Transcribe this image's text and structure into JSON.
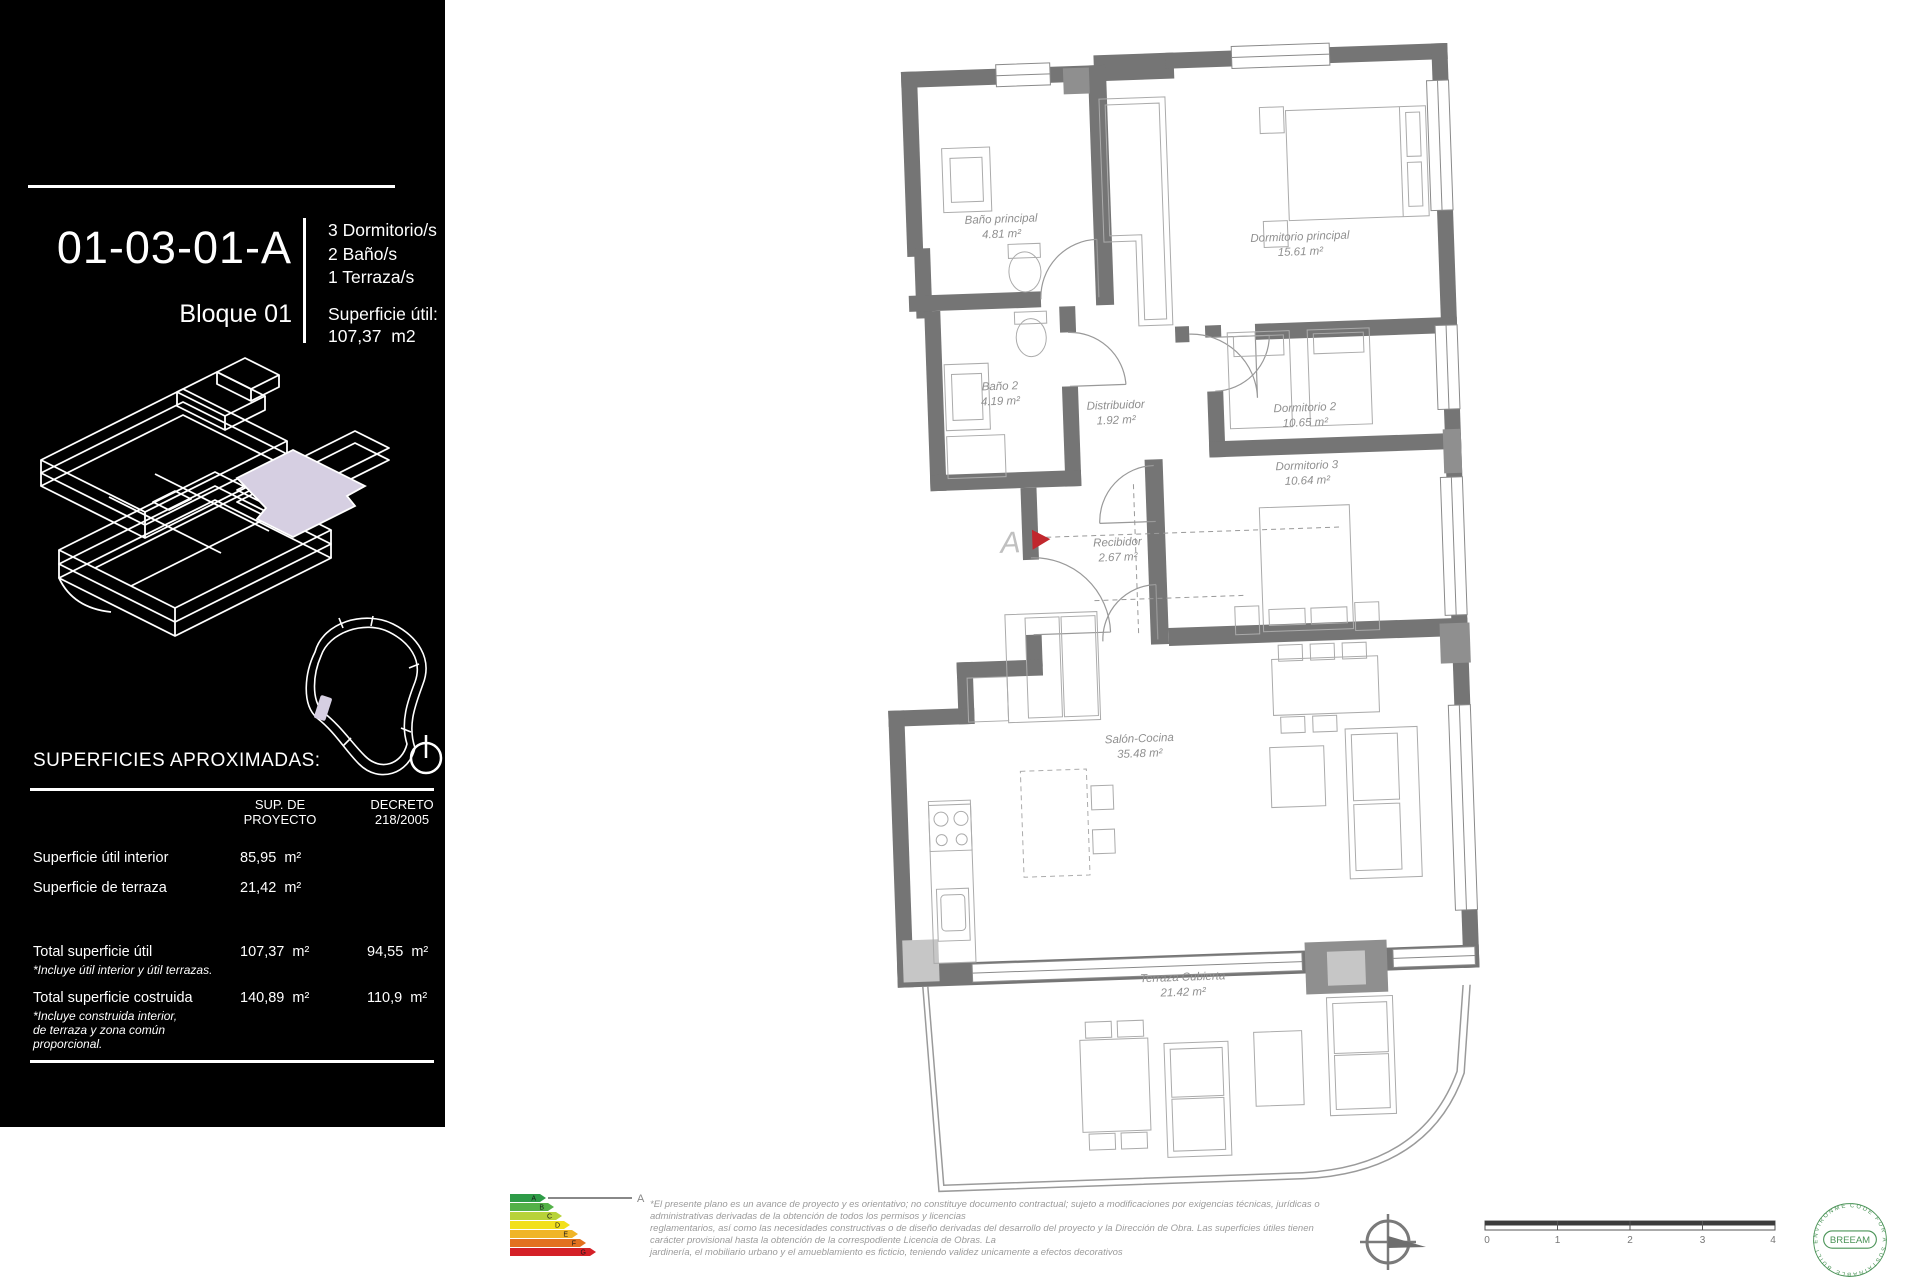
{
  "sidebar": {
    "unit_code": "01-03-01-A",
    "block_label": "Bloque 01",
    "features": {
      "f1": "3 Dormitorio/s",
      "f2": "2 Baño/s",
      "f3": "1 Terraza/s"
    },
    "area_heading": "Superficie útil:",
    "area_value": "107,37  m2",
    "surfaces_heading": "SUPERFICIES APROXIMADAS:",
    "table": {
      "col1_header": "SUP. DE\nPROYECTO",
      "col2_header": "DECRETO\n218/2005",
      "rows": [
        {
          "label": "Superficie útil interior",
          "v1": "85,95  m²",
          "v2": ""
        },
        {
          "label": "Superficie de terraza",
          "v1": "21,42  m²",
          "v2": ""
        },
        {
          "label": "Total superficie útil",
          "note": "*Incluye útil interior y útil terrazas.",
          "v1": "107,37  m²",
          "v2": "94,55  m²"
        },
        {
          "label": "Total superficie costruida",
          "note": "*Incluye construida interior,\nde terraza y zona común\nproporcional.",
          "v1": "140,89  m²",
          "v2": "110,9  m²"
        }
      ]
    },
    "highlight_color": "#d6cfe2"
  },
  "plan": {
    "wall_color": "#757575",
    "rooms": [
      {
        "name": "Baño principal",
        "area": "4.81 m²"
      },
      {
        "name": "Dormitorio principal",
        "area": "15.61 m²"
      },
      {
        "name": "Baño 2",
        "area": "4.19 m²"
      },
      {
        "name": "Distribuidor",
        "area": "1.92 m²"
      },
      {
        "name": "Dormitorio 2",
        "area": "10.65 m²"
      },
      {
        "name": "Dormitorio 3",
        "area": "10.64 m²"
      },
      {
        "name": "Recibidor",
        "area": "2.67 m²"
      },
      {
        "name": "Salón-Cocina",
        "area": "35.48 m²"
      },
      {
        "name": "Terraza Cubierta",
        "area": "21.42 m²"
      }
    ],
    "entrance_label": "A",
    "entrance_marker_color": "#c1272d"
  },
  "footer": {
    "energy": {
      "letters": [
        "A",
        "B",
        "C",
        "D",
        "E",
        "F",
        "G"
      ],
      "colors": [
        "#2e9b47",
        "#53b148",
        "#b8d239",
        "#f2e01c",
        "#f0b528",
        "#e2711f",
        "#d42027"
      ],
      "rating_label": "A"
    },
    "disclaimer": "*El presente plano es un avance de proyecto y es orientativo; no constituye documento contractual; sujeto a modificaciones por exigencias técnicas, jurídicas o\nadministrativas derivadas de la obtención de todos los permisos y licencias\nreglamentarios, así como las necesidades constructivas o de diseño derivadas del desarrollo del proyecto y la Dirección de Obra. Las superficies útiles tienen\ncarácter provisional hasta la obtención de la correspodiente Licencia de Obras. La\njardinería, el mobiliario urbano y el amueblamiento es ficticio, teniendo validez unicamente a efectos decorativos",
    "scale": {
      "ticks": [
        "0",
        "1",
        "2",
        "3",
        "4"
      ]
    },
    "breeam": {
      "name": "BREEAM",
      "ring_text": "CODE FOR A SUSTAINABLE BUILT ENVIRONMENT"
    }
  }
}
